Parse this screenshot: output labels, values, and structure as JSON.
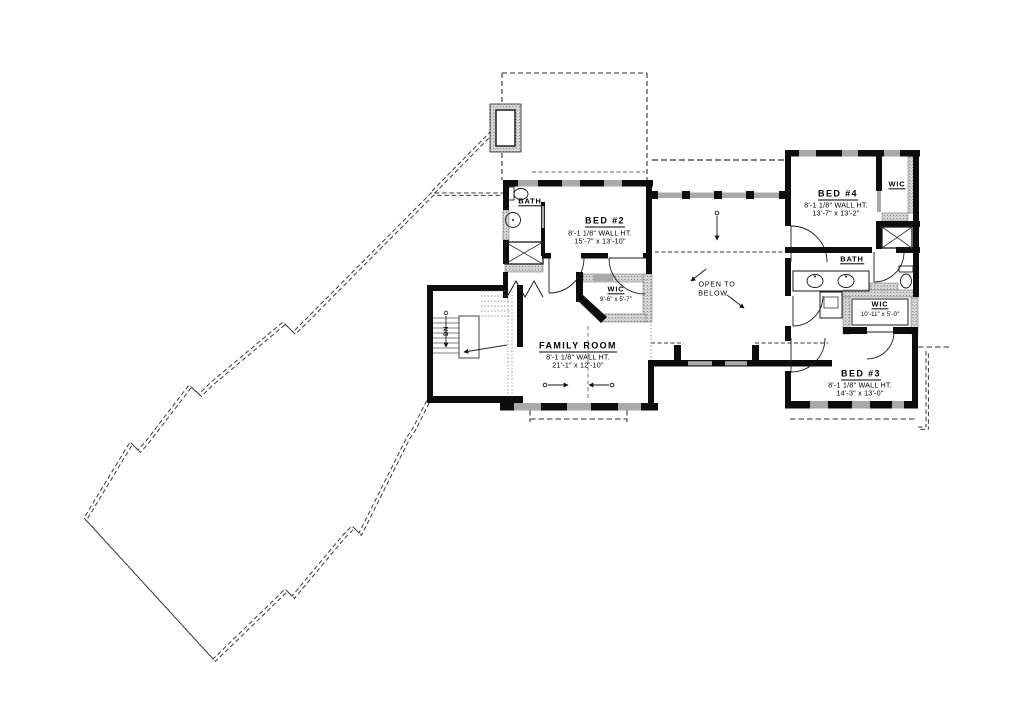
{
  "colors": {
    "wall": "#0d0d0d",
    "window": "#a9a9a9",
    "hatch_dot": "#6e6e6e",
    "dash": "#3a3a3a",
    "paper": "#ffffff"
  },
  "rooms": {
    "bed2": {
      "name": "BED #2",
      "wall_height": "8'-1 1/8\" WALL HT.",
      "dimensions": "15'-7\" x 13'-10\""
    },
    "bed3": {
      "name": "BED #3",
      "wall_height": "8'-1 1/8\" WALL HT.",
      "dimensions": "14'-3\" x 13'-0\""
    },
    "bed4": {
      "name": "BED #4",
      "wall_height": "8'-1 1/8\" WALL HT.",
      "dimensions": "13'-7\" x 13'-2\""
    },
    "family_room": {
      "name": "FAMILY ROOM",
      "wall_height": "8'-1 1/8\" WALL HT.",
      "dimensions": "21'-1\" x 12'-10\""
    },
    "wic_bed2": {
      "name": "WIC",
      "dimensions": "9'-6\" x 5'-7\""
    },
    "wic_bed3": {
      "name": "WIC",
      "dimensions": "10'-11\" x 5'-0\""
    },
    "wic_bed4": {
      "name": "WIC"
    },
    "bath_bed2": {
      "name": "BATH"
    },
    "bath_hall": {
      "name": "BATH"
    },
    "open_to_below": {
      "line1": "OPEN TO",
      "line2": "BELOW"
    },
    "stair": {
      "direction_label": "DN"
    }
  }
}
